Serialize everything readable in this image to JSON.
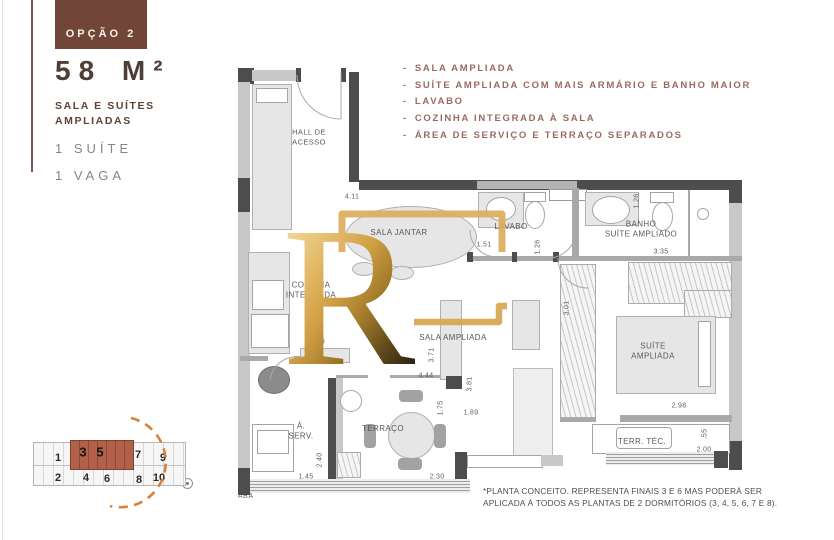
{
  "colors": {
    "brand_brown": "#714639",
    "watermark_gold": "#DCAE5B",
    "accent_orange": "#D6813C",
    "keyplan_highlight": "#B2604A"
  },
  "sidebar": {
    "option_label": "OPÇÃO 2",
    "area_display": "58 M²",
    "subtitle_line1": "SALA E SUÍTES",
    "subtitle_line2": "AMPLIADAS",
    "features": [
      "1 SUÍTE",
      "1 VAGA"
    ]
  },
  "highlights": {
    "prefix": "-",
    "items": [
      "SALA AMPLIADA",
      "SUÍTE AMPLIADA COM MAIS ARMÁRIO E BANHO MAIOR",
      "LAVABO",
      "COZINHA INTEGRADA À SALA",
      "ÁREA DE SERVIÇO E TERRAÇO SEPARADOS"
    ]
  },
  "floorplan": {
    "rooms": {
      "hall": [
        "HALL DE",
        "ACESSO"
      ],
      "sala_jantar": [
        "SALA JANTAR"
      ],
      "lavabo": [
        "LAVABO"
      ],
      "banho": [
        "BANHO",
        "SUÍTE AMPLIADO"
      ],
      "cozinha": [
        "COZINHA",
        "INTEGRADA"
      ],
      "sala": [
        "SALA AMPLIADA"
      ],
      "suite": [
        "SUÍTE",
        "AMPLIADA"
      ],
      "aserv": [
        "Á.",
        "SERV."
      ],
      "terraco": [
        "TERRAÇO"
      ],
      "terrtec": [
        "TERR. TÉC."
      ]
    },
    "dims": {
      "hall_top": "4.11",
      "lavabo_w": "1.51",
      "lavabo_d": "1.26",
      "banho_d": "1.26",
      "banho_w": "3.35",
      "wardrobe_h": "3.01",
      "suite_w": "2.98",
      "sala_h": "3.71",
      "sala_w": "4.44",
      "corridor_h": "3.81",
      "door_h": "1.89",
      "terraco_h": "1.75",
      "aserv_h": "2.40",
      "aserv_w": "1.45",
      "terraco_w": "2.30",
      "terrtec_w": "2.00",
      "terrtec_h": ".55",
      "kitchen_frag": "6"
    },
    "aba_label": "ABA"
  },
  "watermark": {
    "letter": "R"
  },
  "keyplan": {
    "units": [
      "1",
      "3",
      "5",
      "7",
      "9",
      "2",
      "4",
      "6",
      "8",
      "10"
    ],
    "highlighted_units": [
      "3",
      "5"
    ]
  },
  "footnote": {
    "line1": "*PLANTA CONCEITO. REPRESENTA FINAIS  3 E 6 MAS PODERÁ SER",
    "line2": "APLICADA À TODOS AS PLANTAS DE 2 DORMITÓRIOS (3, 4, 5, 6, 7 E 8)."
  }
}
